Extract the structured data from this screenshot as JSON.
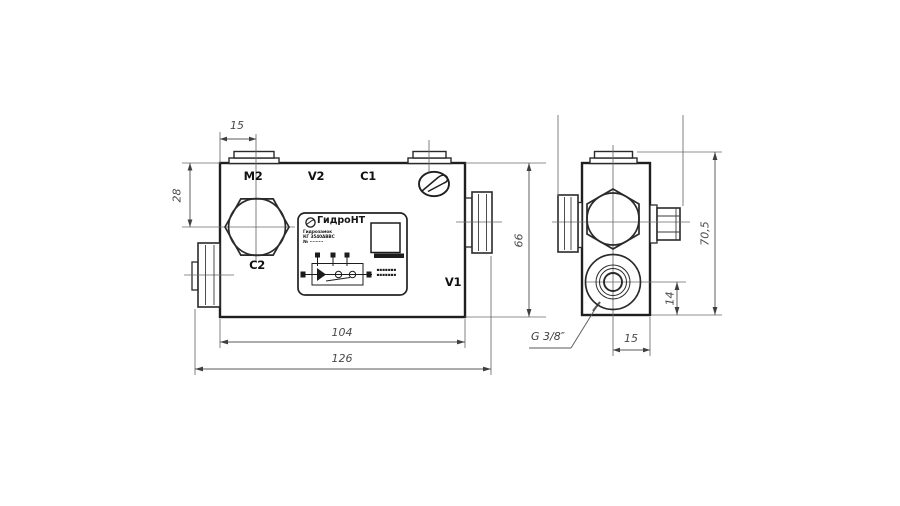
{
  "front_view": {
    "ports": {
      "m2": "M2",
      "v2": "V2",
      "c1": "C1",
      "c2": "C2",
      "v1": "V1"
    },
    "dims": {
      "port_offset_top": "15",
      "plug_center_depth": "28",
      "block_height": "66",
      "block_length": "104",
      "overall_length": "126"
    }
  },
  "side_view": {
    "dims": {
      "overall_height": "70,5",
      "port_center_height": "14",
      "port_center_offset": "15"
    },
    "thread_callout": "G 3/8″"
  },
  "nameplate": {
    "brand": "ГидроНТ",
    "info_lines": [
      "Гидрозамок",
      "КГ 3540АВВС",
      "№ ·········"
    ],
    "note_lines": [
      "▪▪▪▪▪▪▪",
      "▪▪▪▪▪▪▪"
    ]
  }
}
